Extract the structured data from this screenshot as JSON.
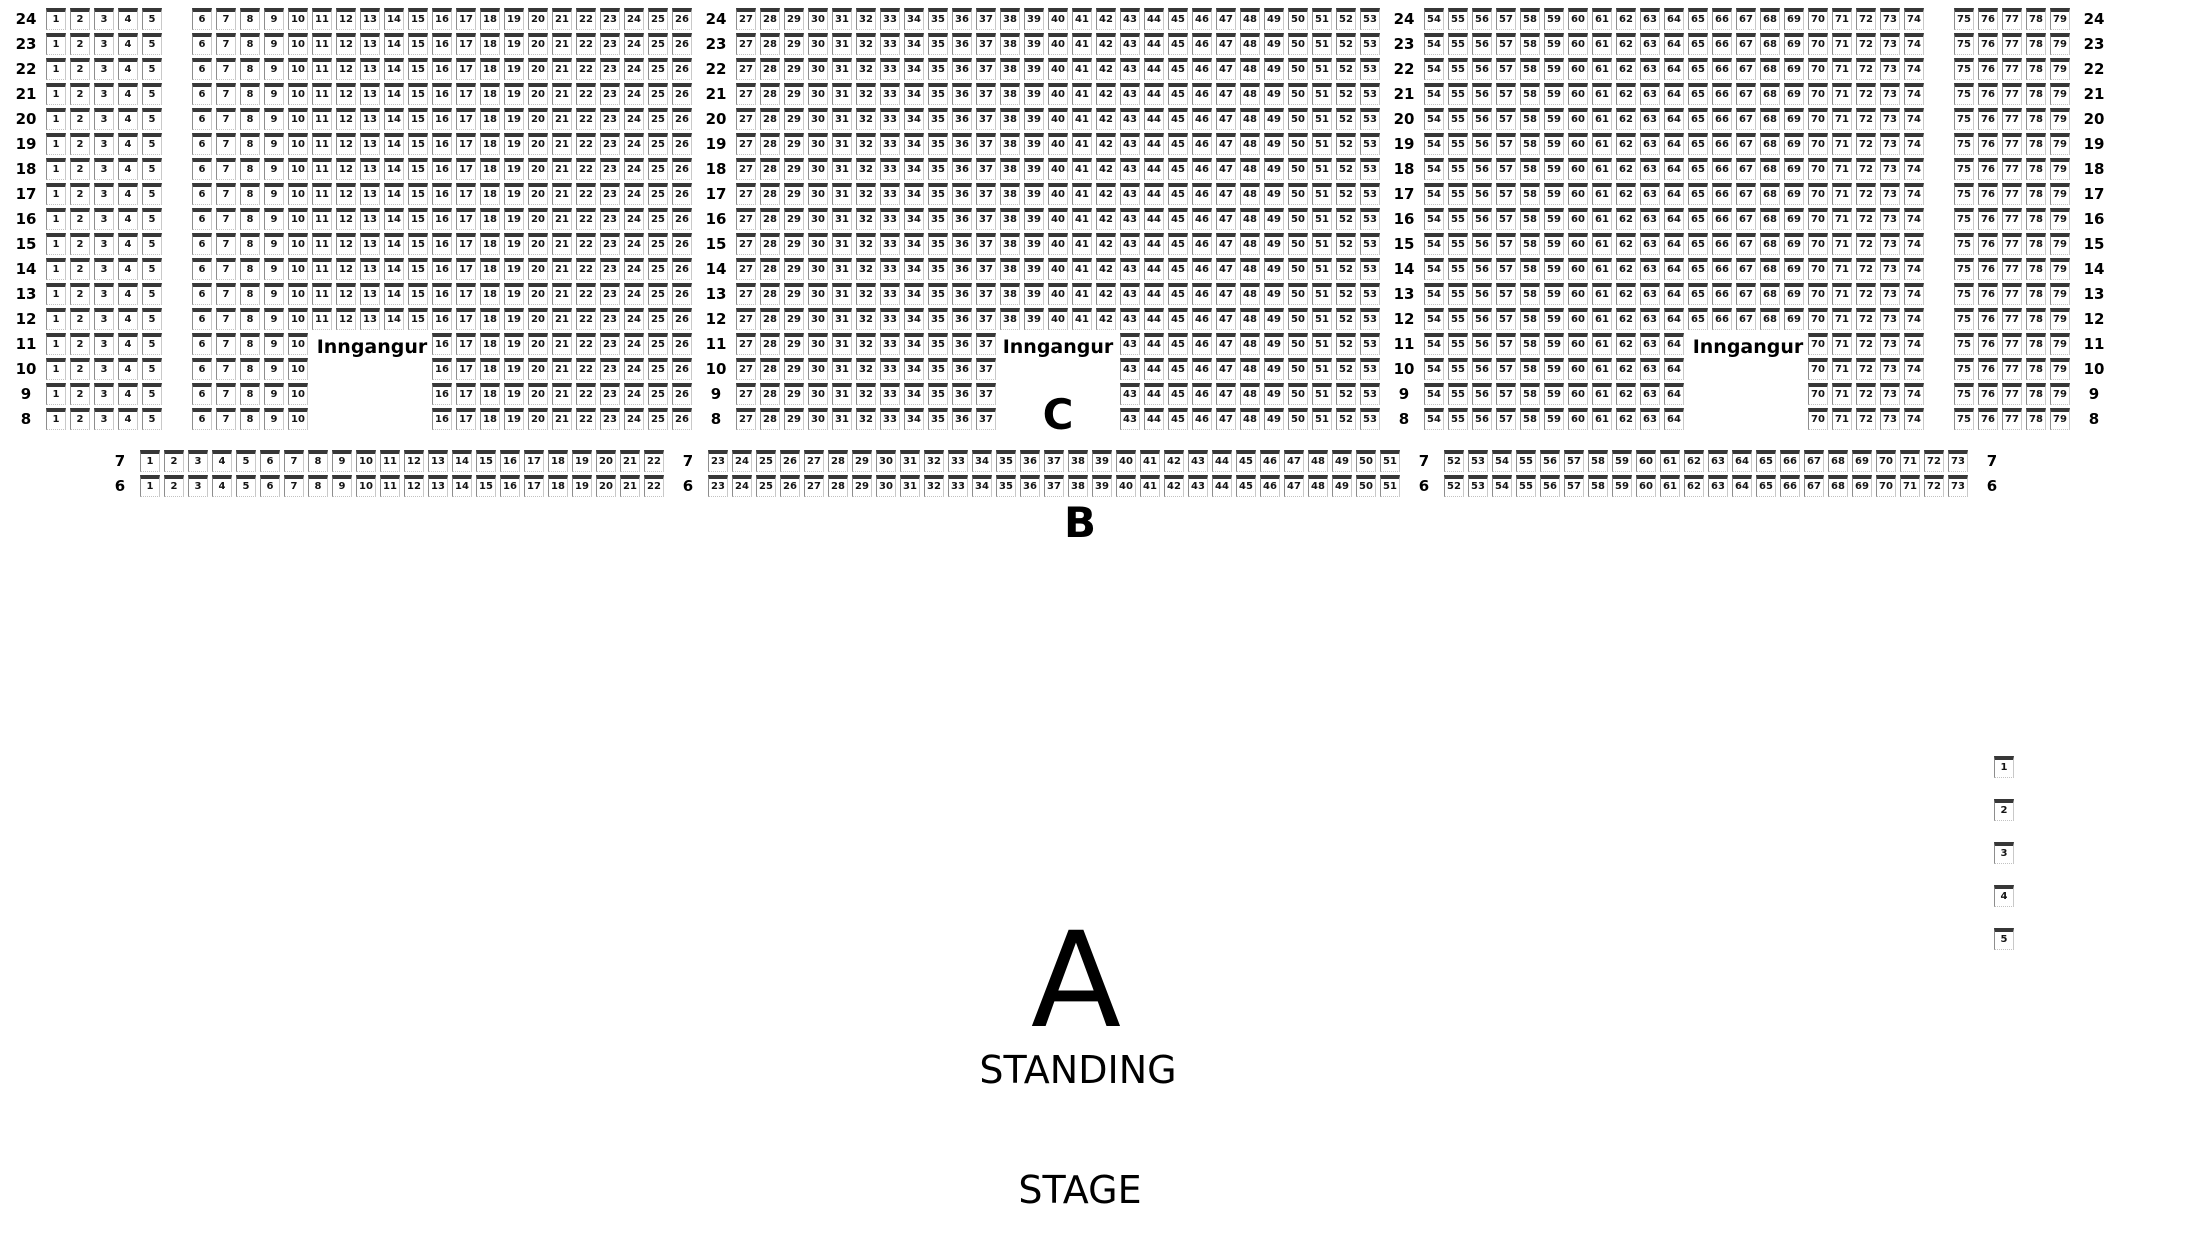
{
  "venue_map": {
    "entrance_label": "Inngangur",
    "section_a_label": "A",
    "section_b_label": "B",
    "section_c_label": "C",
    "standing_label": "STANDING",
    "stage_label": "STAGE",
    "colors": {
      "background": "#ffffff",
      "ink": "#000000",
      "seat_backrest": "#373737",
      "seat_side": "#8d8d8d"
    },
    "upper_rows": {
      "rows": [
        24,
        23,
        22,
        21,
        20,
        19,
        18,
        17,
        16,
        15,
        14,
        13,
        12,
        11,
        10,
        9,
        8
      ],
      "segments": [
        {
          "type": "label"
        },
        {
          "type": "seats",
          "from": 1,
          "to": 5
        },
        {
          "type": "gap"
        },
        {
          "type": "seats",
          "from": 6,
          "to": 26
        },
        {
          "type": "label"
        },
        {
          "type": "seats",
          "from": 27,
          "to": 53
        },
        {
          "type": "label"
        },
        {
          "type": "seats",
          "from": 54,
          "to": 74
        },
        {
          "type": "gap"
        },
        {
          "type": "seats",
          "from": 75,
          "to": 79
        },
        {
          "type": "label"
        }
      ],
      "cutout_rows": [
        11,
        10,
        9,
        8
      ],
      "cutout_seat_ranges": [
        [
          11,
          15
        ],
        [
          38,
          42
        ],
        [
          65,
          69
        ]
      ]
    },
    "lower_rows": {
      "rows": [
        7,
        6
      ],
      "segments": [
        {
          "type": "label"
        },
        {
          "type": "seats",
          "from": 1,
          "to": 22
        },
        {
          "type": "label"
        },
        {
          "type": "seats",
          "from": 23,
          "to": 51
        },
        {
          "type": "label"
        },
        {
          "type": "seats",
          "from": 52,
          "to": 73
        },
        {
          "type": "label"
        }
      ]
    },
    "side_seats": [
      1,
      2,
      3,
      4,
      5
    ]
  }
}
